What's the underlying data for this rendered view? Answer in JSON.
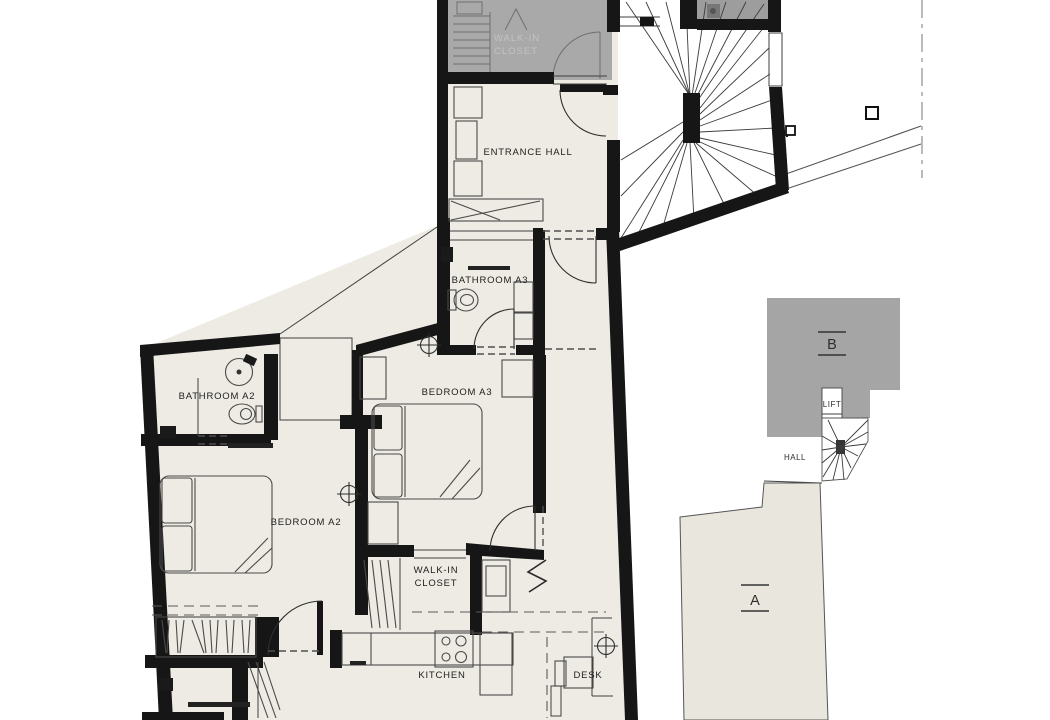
{
  "colors": {
    "background": "#ffffff",
    "wall": "#161616",
    "floor": "#edebe3",
    "section_a_fill": "#e9e6de",
    "gray_block": "#a5a5a5",
    "gray_closet": "#a9a9a9",
    "gray_room": "#9d9d9d",
    "closet_text": "#c3c3c3",
    "line": "#3f3f3f"
  },
  "labels": {
    "closet_top_line1": "WALK-IN",
    "closet_top_line2": "CLOSET",
    "entrance_hall": "ENTRANCE HALL",
    "bathroom_a3": "BATHROOM A3",
    "bathroom_a2": "BATHROOM A2",
    "bedroom_a3": "BEDROOM A3",
    "bedroom_a2": "BEDROOM A2",
    "closet2_line1": "WALK-IN",
    "closet2_line2": "CLOSET",
    "kitchen": "KITCHEN",
    "desk": "DESK",
    "lift": "LIFT",
    "hall": "HALL",
    "section_a": "A",
    "section_b": "B"
  }
}
